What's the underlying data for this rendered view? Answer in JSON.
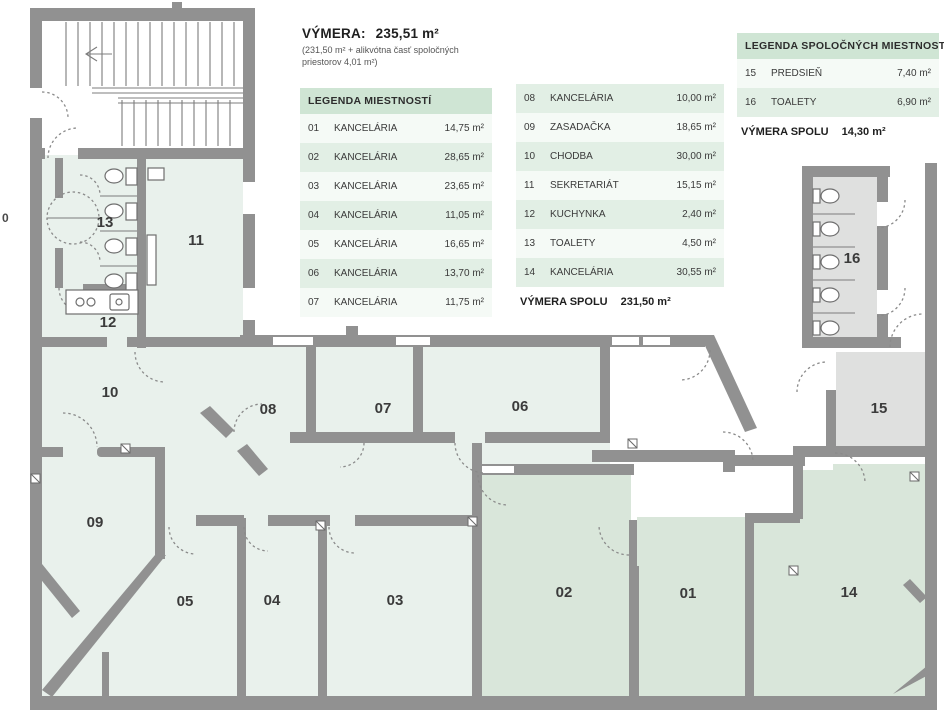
{
  "title_block": {
    "label": "VÝMERA:",
    "value": "235,51 m²",
    "note_line1": "(231,50 m² + alikvótna časť spoločných",
    "note_line2": "priestorov 4,01 m²)"
  },
  "legend_rooms": {
    "title": "LEGENDA MIESTNOSTÍ",
    "col1": [
      {
        "num": "01",
        "name": "KANCELÁRIA",
        "area": "14,75 m²"
      },
      {
        "num": "02",
        "name": "KANCELÁRIA",
        "area": "28,65 m²"
      },
      {
        "num": "03",
        "name": "KANCELÁRIA",
        "area": "23,65 m²"
      },
      {
        "num": "04",
        "name": "KANCELÁRIA",
        "area": "11,05 m²"
      },
      {
        "num": "05",
        "name": "KANCELÁRIA",
        "area": "16,65 m²"
      },
      {
        "num": "06",
        "name": "KANCELÁRIA",
        "area": "13,70 m²"
      },
      {
        "num": "07",
        "name": "KANCELÁRIA",
        "area": "11,75 m²"
      }
    ],
    "col2": [
      {
        "num": "08",
        "name": "KANCELÁRIA",
        "area": "10,00 m²"
      },
      {
        "num": "09",
        "name": "ZASADAČKA",
        "area": "18,65 m²"
      },
      {
        "num": "10",
        "name": "CHODBA",
        "area": "30,00 m²"
      },
      {
        "num": "11",
        "name": "SEKRETARIÁT",
        "area": "15,15 m²"
      },
      {
        "num": "12",
        "name": "KUCHYNKA",
        "area": "2,40 m²"
      },
      {
        "num": "13",
        "name": "TOALETY",
        "area": "4,50 m²"
      },
      {
        "num": "14",
        "name": "KANCELÁRIA",
        "area": "30,55 m²"
      }
    ],
    "total_label": "VÝMERA SPOLU",
    "total_value": "231,50 m²"
  },
  "legend_common": {
    "title": "LEGENDA SPOLOČNÝCH MIESTNOSTÍ",
    "rows": [
      {
        "num": "15",
        "name": "PREDSIEŇ",
        "area": "7,40 m²"
      },
      {
        "num": "16",
        "name": "TOALETY",
        "area": "6,90 m²"
      }
    ],
    "total_label": "VÝMERA SPOLU",
    "total_value": "14,30 m²"
  },
  "plan": {
    "labels": {
      "r01": "01",
      "r02": "02",
      "r03": "03",
      "r04": "04",
      "r05": "05",
      "r06": "06",
      "r07": "07",
      "r08": "08",
      "r09": "09",
      "r10": "10",
      "r11": "11",
      "r12": "12",
      "r13": "13",
      "r14": "14",
      "r15": "15",
      "r16": "16",
      "edge": "0"
    },
    "colors": {
      "wall": "#919191",
      "room_fill": "#e9f1ec",
      "highlight_fill": "#d9e6da",
      "common_fill": "#dfe0df",
      "legend_header": "#cfe5d4",
      "legend_row_even": "#e2efe5",
      "legend_row_odd": "#f5faf6"
    }
  }
}
